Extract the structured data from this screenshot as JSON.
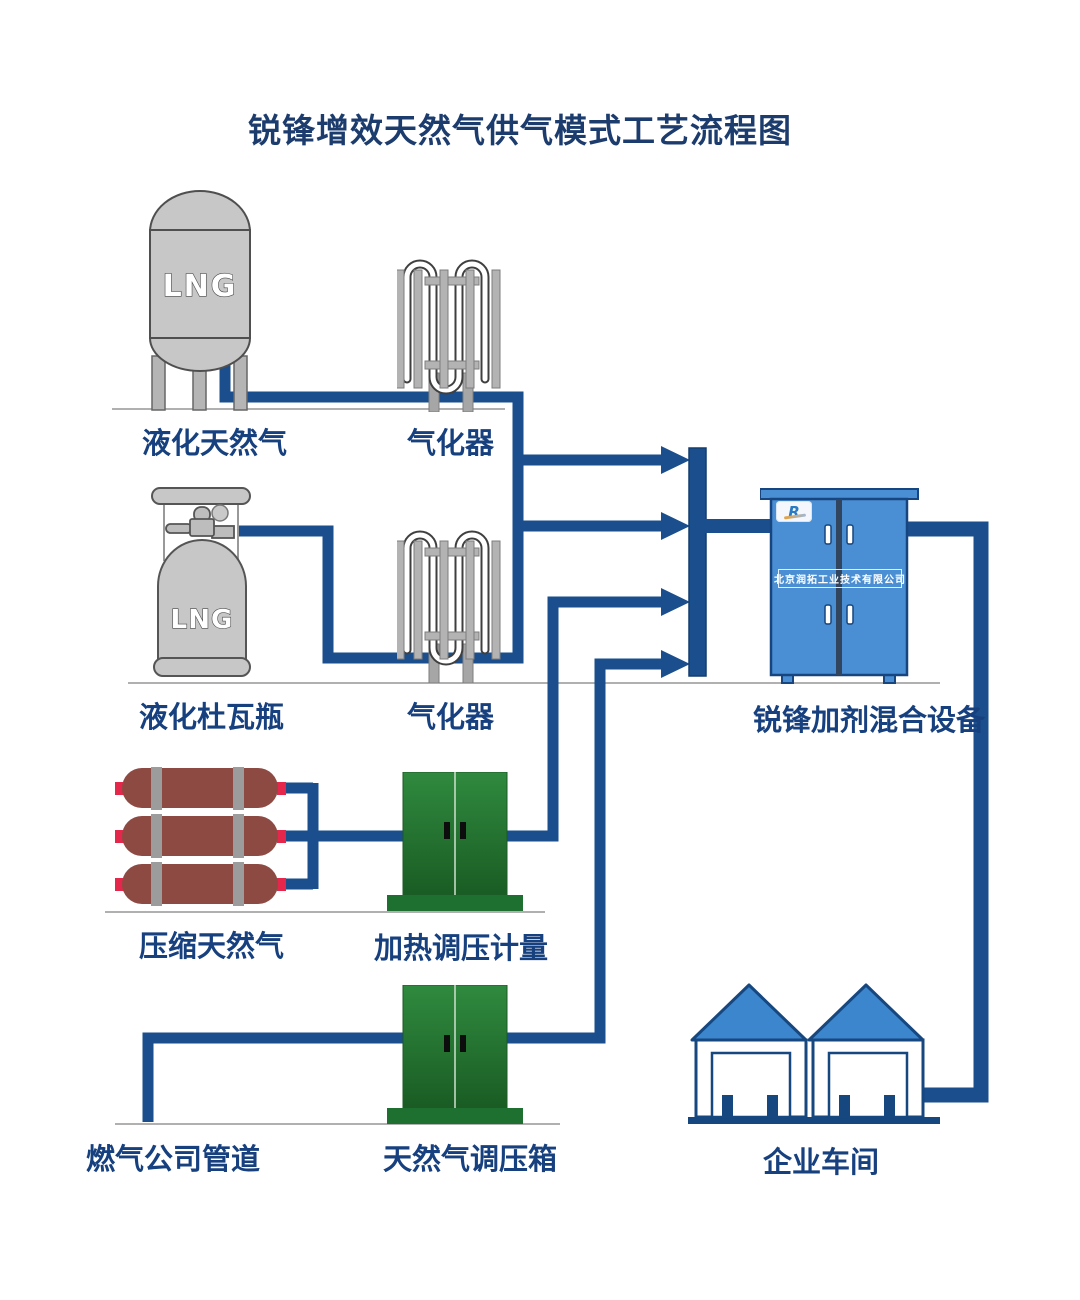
{
  "title": "锐锋增效天然气供气模式工艺流程图",
  "nodes": {
    "lng_tank": {
      "label": "液化天然气",
      "tank_text": "LNG"
    },
    "vaporizer_top": {
      "label": "气化器"
    },
    "dewar": {
      "label": "液化杜瓦瓶",
      "tank_text": "LNG"
    },
    "vaporizer_mid": {
      "label": "气化器"
    },
    "cng": {
      "label": "压缩天然气"
    },
    "heater": {
      "label": "加热调压计量"
    },
    "mixer": {
      "label": "锐锋加剂混合设备",
      "company": "北京润拓工业技术有限公司",
      "logo_text": "R"
    },
    "pipeline": {
      "label": "燃气公司管道"
    },
    "regulator": {
      "label": "天然气调压箱"
    },
    "workshop": {
      "label": "企业车间"
    }
  },
  "colors": {
    "title_text": "#1d3c6e",
    "label_text": "#17407f",
    "pipe_blue": "#1a4e8c",
    "tank_gray": "#c7c7c7",
    "cng_maroon": "#8d4a43",
    "cng_nozzle": "#e5274b",
    "cabinet_green_top": "#2f8a3e",
    "cabinet_green_bottom": "#1a5c24",
    "cabinet_blue": "#4a8fd3",
    "outline_navy": "#16457f",
    "roof_blue": "#3c86cd"
  }
}
